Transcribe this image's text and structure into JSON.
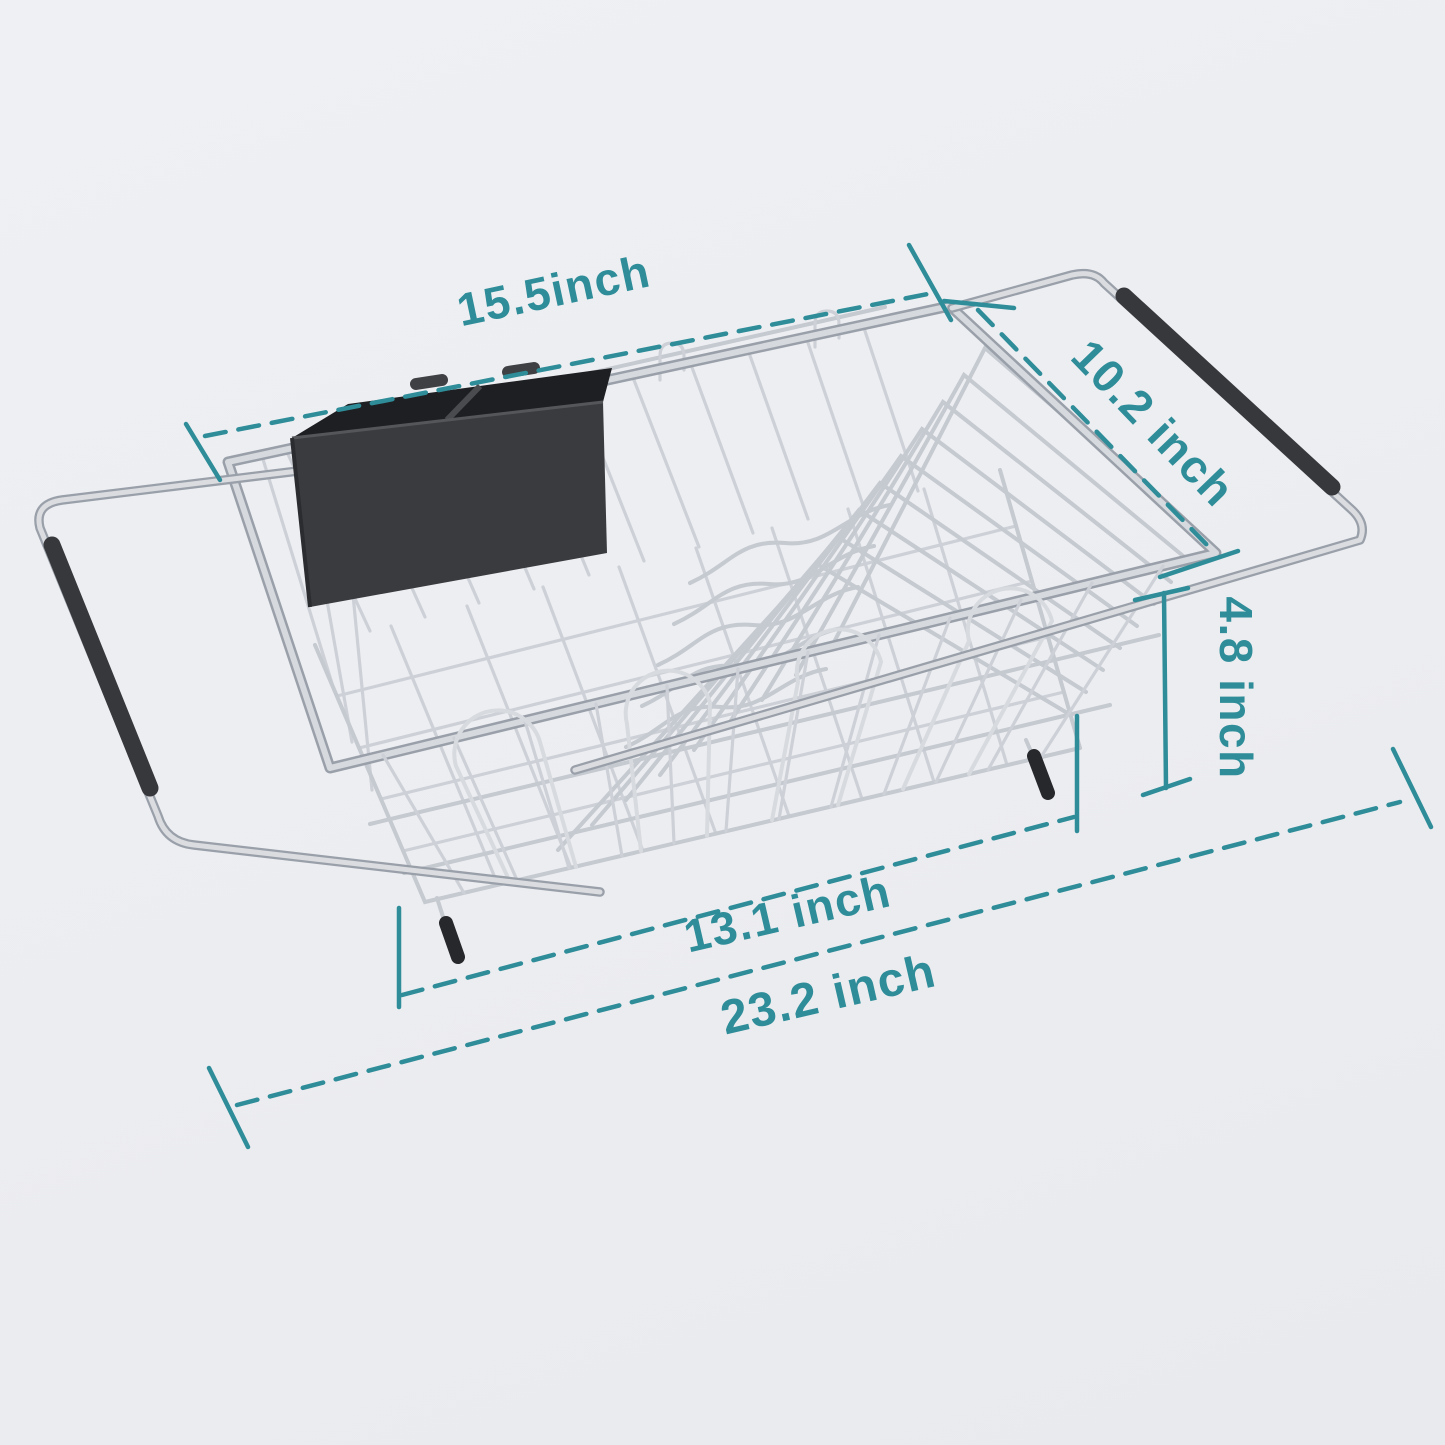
{
  "page": {
    "background_color": "#ECEDF1",
    "accent_color": "#2E8D98",
    "wire_color": "#C5C9D0",
    "plastic_color": "#3A3B3E"
  },
  "diagram": {
    "product_name": "expandable-over-sink-dish-drying-rack",
    "labels": {
      "top_width": "15.5inch",
      "depth": "10.2 inch",
      "height": "4.8 inch",
      "basket_length": "13.1 inch",
      "extended_length": "23.2 inch"
    }
  }
}
